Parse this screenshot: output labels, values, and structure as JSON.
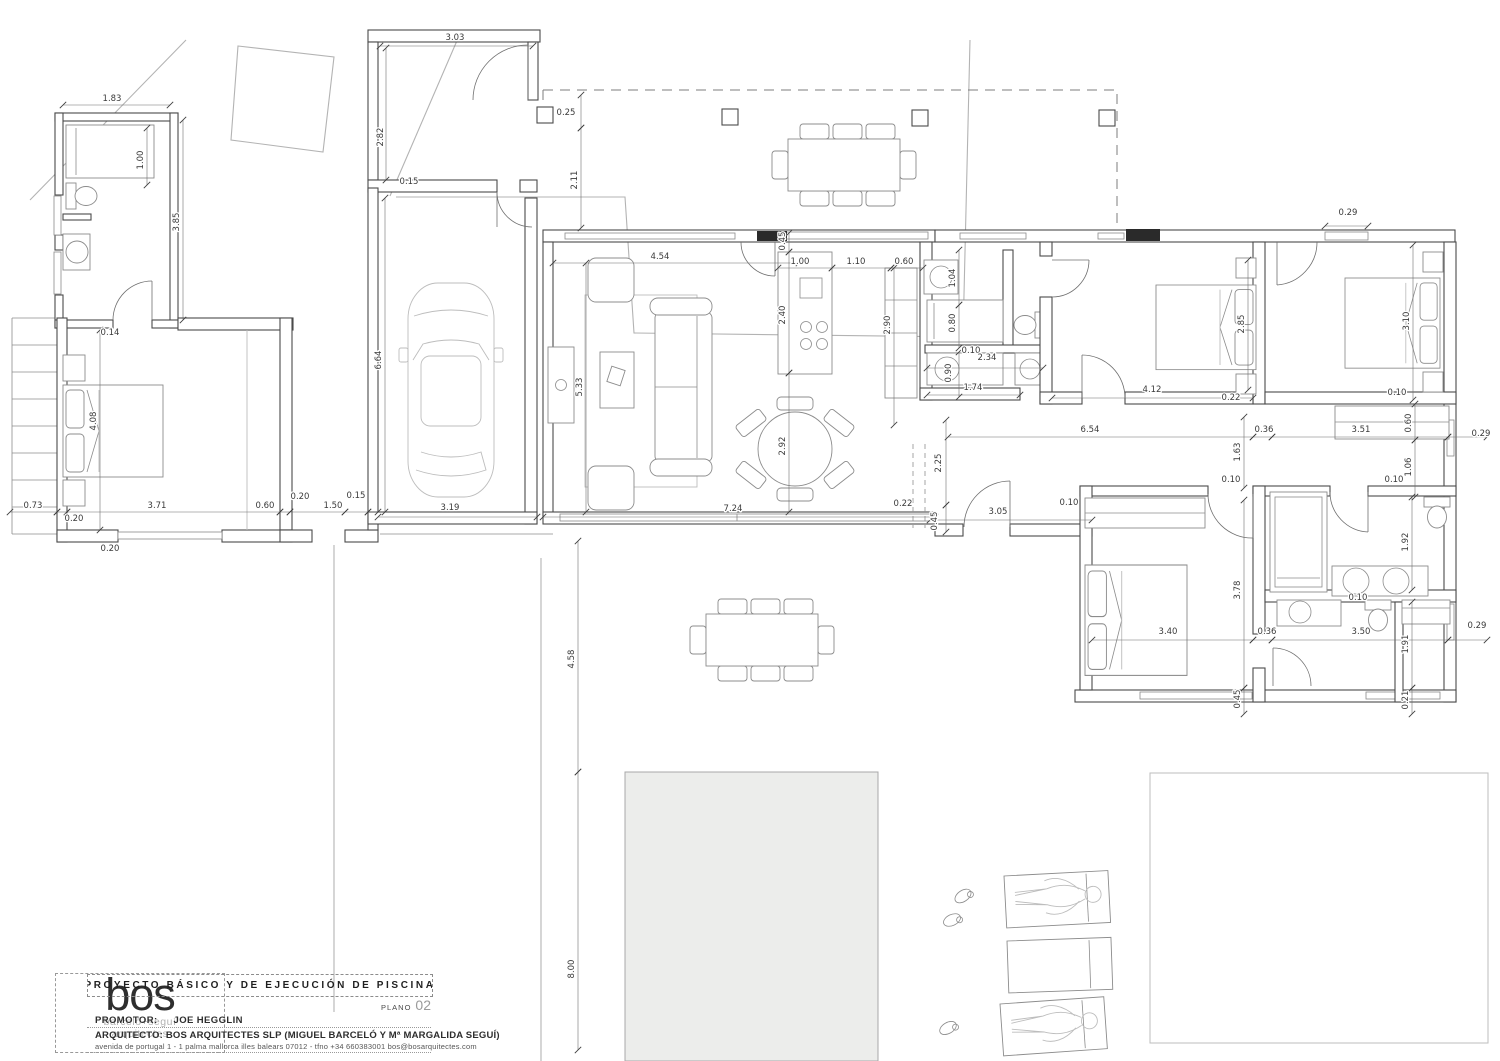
{
  "title_block": {
    "logo_text": "bos",
    "logo_sub1": "barceló+seguí",
    "logo_sub2": "arquitectes",
    "project_title": "PROYECTO BÁSICO Y DE EJECUCIÓN DE PISCINA",
    "plano_label": "PLANO",
    "plano_number": "02",
    "promotor_label": "PROMOTOR:",
    "promotor_value": "JOE HEGGLIN",
    "arquitecto_label": "ARQUITECTO:",
    "arquitecto_value": "BOS ARQUITECTES SLP (MIGUEL BARCELÓ Y Mª MARGALIDA SEGUÍ)",
    "address": "avenida de portugal  1 - 1  palma mallorca illes balears 07012 - tfno  +34  660383001   bos@bosarquitectes.com"
  },
  "colors": {
    "wall": "#4a4a4a",
    "thin_line": "#8c8c8c",
    "dimension": "#6f6f6f",
    "site_boundary": "#b3b3b3",
    "pool_fill": "#ecedeb",
    "paper": "#ffffff"
  },
  "dimensions": [
    {
      "t": "3.03",
      "x": 455,
      "y": 40,
      "r": 0
    },
    {
      "t": "1.83",
      "x": 112,
      "y": 101,
      "r": 0
    },
    {
      "t": "0.15",
      "x": 409,
      "y": 184,
      "r": 0
    },
    {
      "t": "0.25",
      "x": 566,
      "y": 115,
      "r": 0
    },
    {
      "t": "0.14",
      "x": 110,
      "y": 335,
      "r": 0
    },
    {
      "t": "0.73",
      "x": 33,
      "y": 508,
      "r": 0
    },
    {
      "t": "0.20",
      "x": 74,
      "y": 521,
      "r": 0
    },
    {
      "t": "3.71",
      "x": 157,
      "y": 508,
      "r": 0
    },
    {
      "t": "0.60",
      "x": 265,
      "y": 508,
      "r": 0
    },
    {
      "t": "0.20",
      "x": 300,
      "y": 499,
      "r": 0
    },
    {
      "t": "1.50",
      "x": 333,
      "y": 508,
      "r": 0
    },
    {
      "t": "0.20",
      "x": 110,
      "y": 551,
      "r": 0
    },
    {
      "t": "0.15",
      "x": 356,
      "y": 498,
      "r": 0
    },
    {
      "t": "3.19",
      "x": 450,
      "y": 510,
      "r": 0
    },
    {
      "t": "4.54",
      "x": 660,
      "y": 259,
      "r": 0
    },
    {
      "t": "1.00",
      "x": 800,
      "y": 264,
      "r": 0
    },
    {
      "t": "1.10",
      "x": 856,
      "y": 264,
      "r": 0
    },
    {
      "t": "0.60",
      "x": 904,
      "y": 264,
      "r": 0
    },
    {
      "t": "0.10",
      "x": 971,
      "y": 353,
      "r": 0
    },
    {
      "t": "2.34",
      "x": 987,
      "y": 360,
      "r": 0
    },
    {
      "t": "1.74",
      "x": 973,
      "y": 390,
      "r": 0
    },
    {
      "t": "0.22",
      "x": 903,
      "y": 506,
      "r": 0
    },
    {
      "t": "7.24",
      "x": 733,
      "y": 511,
      "r": 0
    },
    {
      "t": "3.05",
      "x": 998,
      "y": 514,
      "r": 0
    },
    {
      "t": "0.10",
      "x": 1069,
      "y": 505,
      "r": 0
    },
    {
      "t": "6.54",
      "x": 1090,
      "y": 432,
      "r": 0
    },
    {
      "t": "0.36",
      "x": 1264,
      "y": 432,
      "r": 0
    },
    {
      "t": "3.51",
      "x": 1361,
      "y": 432,
      "r": 0
    },
    {
      "t": "0.29",
      "x": 1481,
      "y": 436,
      "r": 0
    },
    {
      "t": "4.12",
      "x": 1152,
      "y": 392,
      "r": 0
    },
    {
      "t": "0.22",
      "x": 1231,
      "y": 400,
      "r": 0
    },
    {
      "t": "0.29",
      "x": 1348,
      "y": 215,
      "r": 0
    },
    {
      "t": "0.10",
      "x": 1397,
      "y": 395,
      "r": 0
    },
    {
      "t": "0.10",
      "x": 1231,
      "y": 482,
      "r": 0
    },
    {
      "t": "0.10",
      "x": 1394,
      "y": 482,
      "r": 0
    },
    {
      "t": "0.10",
      "x": 1358,
      "y": 600,
      "r": 0
    },
    {
      "t": "3.40",
      "x": 1168,
      "y": 634,
      "r": 0
    },
    {
      "t": "0.36",
      "x": 1267,
      "y": 634,
      "r": 0
    },
    {
      "t": "3.50",
      "x": 1361,
      "y": 634,
      "r": 0
    },
    {
      "t": "0.29",
      "x": 1477,
      "y": 628,
      "r": 0
    },
    {
      "t": "2.82",
      "x": 383,
      "y": 137,
      "r": -90
    },
    {
      "t": "1.00",
      "x": 143,
      "y": 160,
      "r": -90
    },
    {
      "t": "3.85",
      "x": 179,
      "y": 222,
      "r": -90
    },
    {
      "t": "2.11",
      "x": 577,
      "y": 180,
      "r": -90
    },
    {
      "t": "6.64",
      "x": 381,
      "y": 360,
      "r": -90
    },
    {
      "t": "5.33",
      "x": 582,
      "y": 387,
      "r": -90
    },
    {
      "t": "4.08",
      "x": 96,
      "y": 421,
      "r": -90
    },
    {
      "t": "0.45",
      "x": 785,
      "y": 241,
      "r": -90
    },
    {
      "t": "2.40",
      "x": 785,
      "y": 315,
      "r": -90
    },
    {
      "t": "2.90",
      "x": 890,
      "y": 325,
      "r": -90
    },
    {
      "t": "2.92",
      "x": 785,
      "y": 446,
      "r": -90
    },
    {
      "t": "1.04",
      "x": 955,
      "y": 278,
      "r": -90
    },
    {
      "t": "0.80",
      "x": 955,
      "y": 323,
      "r": -90
    },
    {
      "t": "0.90",
      "x": 951,
      "y": 373,
      "r": -90
    },
    {
      "t": "2.25",
      "x": 941,
      "y": 463,
      "r": -90
    },
    {
      "t": "0.45",
      "x": 937,
      "y": 521,
      "r": -90
    },
    {
      "t": "2.85",
      "x": 1244,
      "y": 324,
      "r": -90
    },
    {
      "t": "3.10",
      "x": 1409,
      "y": 321,
      "r": -90
    },
    {
      "t": "1.63",
      "x": 1240,
      "y": 452,
      "r": -90
    },
    {
      "t": "0.60",
      "x": 1411,
      "y": 423,
      "r": -90
    },
    {
      "t": "1.06",
      "x": 1411,
      "y": 467,
      "r": -90
    },
    {
      "t": "3.78",
      "x": 1240,
      "y": 590,
      "r": -90
    },
    {
      "t": "1.92",
      "x": 1408,
      "y": 542,
      "r": -90
    },
    {
      "t": "1.91",
      "x": 1408,
      "y": 644,
      "r": -90
    },
    {
      "t": "0.45",
      "x": 1240,
      "y": 699,
      "r": -90
    },
    {
      "t": "0.21",
      "x": 1408,
      "y": 700,
      "r": -90
    },
    {
      "t": "4.58",
      "x": 574,
      "y": 659,
      "r": -90
    },
    {
      "t": "8.00",
      "x": 574,
      "y": 969,
      "r": -90
    }
  ]
}
